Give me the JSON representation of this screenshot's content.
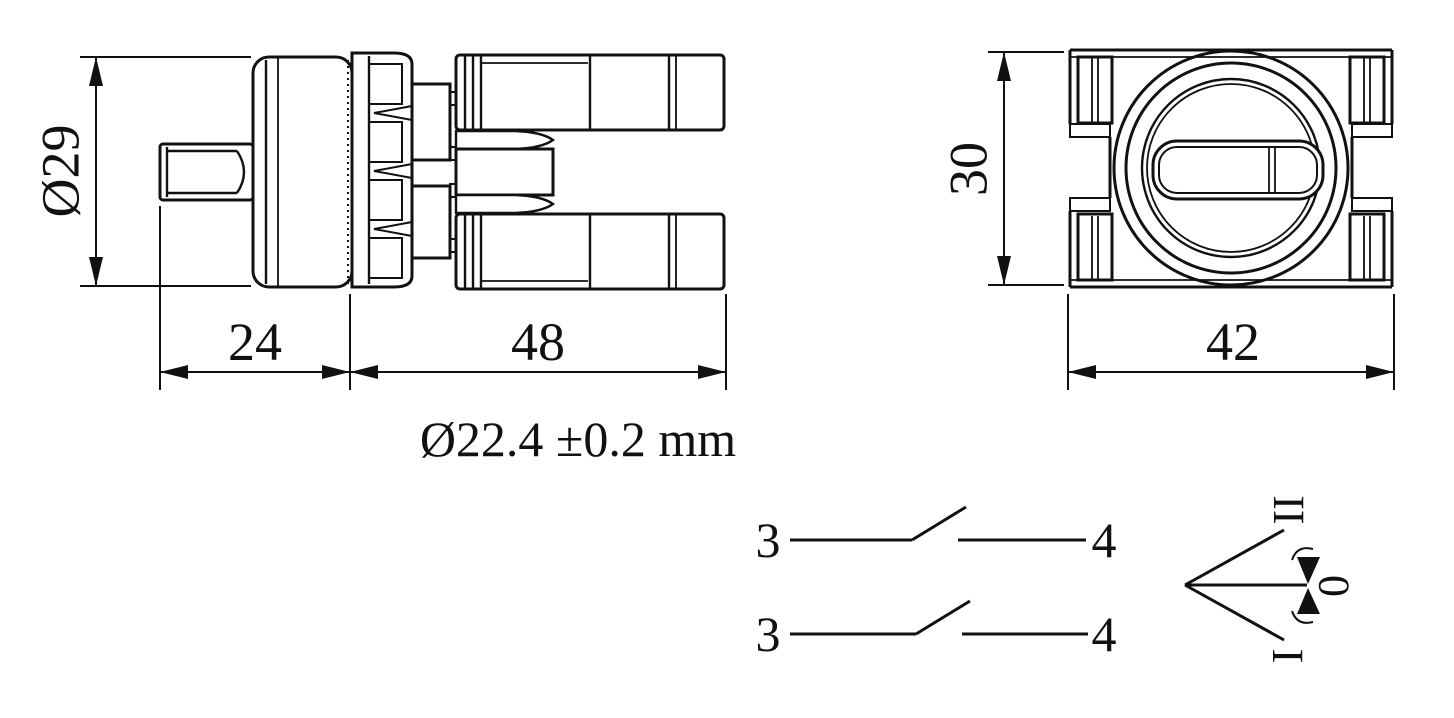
{
  "title": "Selector switch dimension drawing",
  "colors": {
    "ink": "#111111",
    "background": "#ffffff"
  },
  "side_view": {
    "label": "side view of selector switch",
    "dims": {
      "diameter": "Ø29",
      "front_depth": "24",
      "body_depth": "48"
    }
  },
  "front_view": {
    "label": "front view of selector switch",
    "dims": {
      "height": "30",
      "width": "42"
    }
  },
  "mounting_note": "Ø22.4 ±0.2 mm",
  "contact_diagram": {
    "rows": [
      {
        "left_terminal": "3",
        "right_terminal": "4"
      },
      {
        "left_terminal": "3",
        "right_terminal": "4"
      }
    ]
  },
  "position_diagram": {
    "top": "II",
    "center": "0",
    "bottom": "I"
  }
}
